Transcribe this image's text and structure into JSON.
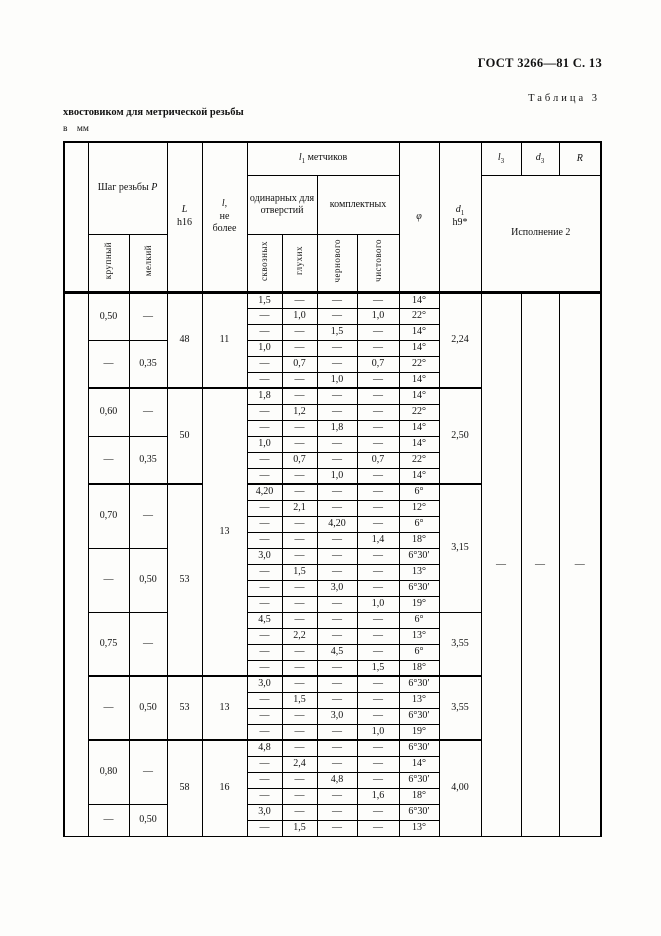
{
  "page": {
    "doc_ref": "ГОСТ 3266—81 С. 13",
    "table_caption": "Таблица 3",
    "continuation_title": "хвостовиком для метрической резьбы",
    "units_note": "в мм"
  },
  "table": {
    "header": {
      "pitch_label": "Шаг резьбы",
      "pitch_var": "P",
      "pitch_coarse": "крупный",
      "pitch_fine": "мелкий",
      "L_var": "L",
      "L_tol": "h16",
      "l_var": "l,",
      "l_note1": "не",
      "l_note2": "более",
      "l1_var": "l",
      "l1_sub": "1",
      "l1_rest": "метчиков",
      "single_group": "одинарных для отверстий",
      "complete_group": "комплектных",
      "through": "сквозных",
      "blind": "глухих",
      "rough": "чернового",
      "finish": "чистового",
      "phi": "φ",
      "d1_var": "d",
      "d1_sub": "1",
      "d1_tol": "h9*",
      "l3_var": "l",
      "l3_sub": "3",
      "d3_var": "d",
      "d3_sub": "3",
      "R_var": "R",
      "ispolnenie": "Исполнение 2"
    },
    "far": {
      "spacer": "",
      "l3": "—",
      "d3": "—",
      "R": "—"
    },
    "rows": [
      {
        "m": {
          "pc": {
            "t": "0,50",
            "r": 3
          },
          "pf": {
            "t": "—",
            "r": 3
          },
          "L": {
            "t": "48",
            "r": 6
          },
          "l": {
            "t": "11",
            "r": 6
          },
          "d1": {
            "t": "2,24",
            "r": 6
          }
        },
        "c": [
          "1,5",
          "—",
          "—",
          "—",
          "14°"
        ]
      },
      {
        "c": [
          "—",
          "1,0",
          "—",
          "1,0",
          "22°"
        ]
      },
      {
        "c": [
          "—",
          "—",
          "1,5",
          "—",
          "14°"
        ]
      },
      {
        "m": {
          "pc": {
            "t": "—",
            "r": 3
          },
          "pf": {
            "t": "0,35",
            "r": 3
          }
        },
        "c": [
          "1,0",
          "—",
          "—",
          "—",
          "14°"
        ]
      },
      {
        "c": [
          "—",
          "0,7",
          "—",
          "0,7",
          "22°"
        ]
      },
      {
        "c": [
          "—",
          "—",
          "1,0",
          "—",
          "14°"
        ]
      },
      {
        "s": true,
        "m": {
          "pc": {
            "t": "0,60",
            "r": 3
          },
          "pf": {
            "t": "—",
            "r": 3
          },
          "L": {
            "t": "50",
            "r": 6
          },
          "l": {
            "t": "13",
            "r": 18
          },
          "d1": {
            "t": "2,50",
            "r": 6
          }
        },
        "c": [
          "1,8",
          "—",
          "—",
          "—",
          "14°"
        ]
      },
      {
        "c": [
          "—",
          "1,2",
          "—",
          "—",
          "22°"
        ]
      },
      {
        "c": [
          "—",
          "—",
          "1,8",
          "—",
          "14°"
        ]
      },
      {
        "m": {
          "pc": {
            "t": "—",
            "r": 3
          },
          "pf": {
            "t": "0,35",
            "r": 3
          }
        },
        "c": [
          "1,0",
          "—",
          "—",
          "—",
          "14°"
        ]
      },
      {
        "c": [
          "—",
          "0,7",
          "—",
          "0,7",
          "22°"
        ]
      },
      {
        "c": [
          "—",
          "—",
          "1,0",
          "—",
          "14°"
        ]
      },
      {
        "s": true,
        "m": {
          "pc": {
            "t": "0,70",
            "r": 4
          },
          "pf": {
            "t": "—",
            "r": 4
          },
          "L": {
            "t": "53",
            "r": 12
          },
          "d1": {
            "t": "3,15",
            "r": 8
          }
        },
        "c": [
          "4,20",
          "—",
          "—",
          "—",
          "6°"
        ]
      },
      {
        "c": [
          "—",
          "2,1",
          "—",
          "—",
          "12°"
        ]
      },
      {
        "c": [
          "—",
          "—",
          "4,20",
          "—",
          "6°"
        ]
      },
      {
        "c": [
          "—",
          "—",
          "—",
          "1,4",
          "18°"
        ]
      },
      {
        "m": {
          "pc": {
            "t": "—",
            "r": 4
          },
          "pf": {
            "t": "0,50",
            "r": 4
          }
        },
        "c": [
          "3,0",
          "—",
          "—",
          "—",
          "6°30′"
        ]
      },
      {
        "c": [
          "—",
          "1,5",
          "—",
          "—",
          "13°"
        ]
      },
      {
        "c": [
          "—",
          "—",
          "3,0",
          "—",
          "6°30′"
        ]
      },
      {
        "c": [
          "—",
          "—",
          "—",
          "1,0",
          "19°"
        ]
      },
      {
        "m": {
          "pc": {
            "t": "0,75",
            "r": 4
          },
          "pf": {
            "t": "—",
            "r": 4
          },
          "d1": {
            "t": "3,55",
            "r": 4
          }
        },
        "c": [
          "4,5",
          "—",
          "—",
          "—",
          "6°"
        ]
      },
      {
        "c": [
          "—",
          "2,2",
          "—",
          "—",
          "13°"
        ]
      },
      {
        "c": [
          "—",
          "—",
          "4,5",
          "—",
          "6°"
        ]
      },
      {
        "c": [
          "—",
          "—",
          "—",
          "1,5",
          "18°"
        ]
      },
      {
        "s": true,
        "m": {
          "pc": {
            "t": "—",
            "r": 4
          },
          "pf": {
            "t": "0,50",
            "r": 4
          },
          "L": {
            "t": "53",
            "r": 4
          },
          "l": {
            "t": "13",
            "r": 4
          },
          "d1": {
            "t": "3,55",
            "r": 4
          }
        },
        "c": [
          "3,0",
          "—",
          "—",
          "—",
          "6°30′"
        ]
      },
      {
        "c": [
          "—",
          "1,5",
          "—",
          "—",
          "13°"
        ]
      },
      {
        "c": [
          "—",
          "—",
          "3,0",
          "—",
          "6°30′"
        ]
      },
      {
        "c": [
          "—",
          "—",
          "—",
          "1,0",
          "19°"
        ]
      },
      {
        "s": true,
        "m": {
          "pc": {
            "t": "0,80",
            "r": 4
          },
          "pf": {
            "t": "—",
            "r": 4
          },
          "L": {
            "t": "58",
            "r": 6
          },
          "l": {
            "t": "16",
            "r": 6
          },
          "d1": {
            "t": "4,00",
            "r": 6
          }
        },
        "c": [
          "4,8",
          "—",
          "—",
          "—",
          "6°30′"
        ]
      },
      {
        "c": [
          "—",
          "2,4",
          "—",
          "—",
          "14°"
        ]
      },
      {
        "c": [
          "—",
          "—",
          "4,8",
          "—",
          "6°30′"
        ]
      },
      {
        "c": [
          "—",
          "—",
          "—",
          "1,6",
          "18°"
        ]
      },
      {
        "m": {
          "pc": {
            "t": "—",
            "r": 2
          },
          "pf": {
            "t": "0,50",
            "r": 2
          }
        },
        "c": [
          "3,0",
          "—",
          "—",
          "—",
          "6°30′"
        ]
      },
      {
        "c": [
          "—",
          "1,5",
          "—",
          "—",
          "13°"
        ]
      }
    ]
  }
}
